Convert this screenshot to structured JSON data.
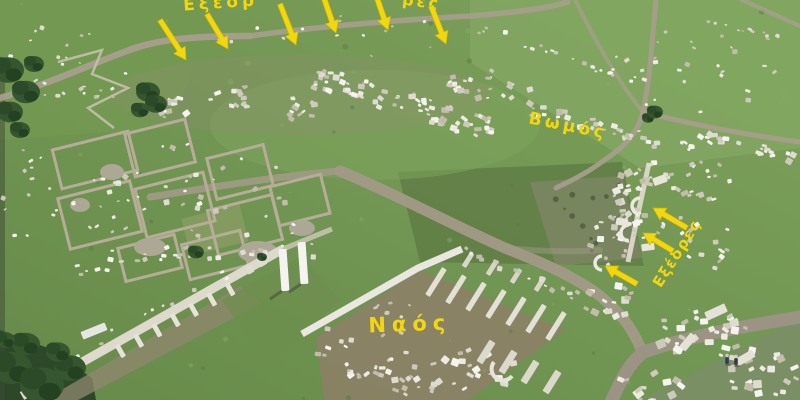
{
  "photo": {
    "kind": "annotated-aerial-photograph",
    "subject": "archaeological-site-ruins"
  },
  "annotations": {
    "text_color": "#f2d70e",
    "arrow_color": "#f2d70e",
    "labels": [
      {
        "id": "exedres-top-fragment",
        "text": "Εξέδρ",
        "x": 221,
        "y": 8,
        "rot": -4,
        "fs": 17,
        "ls": 4
      },
      {
        "id": "res-top-fragment",
        "text": "ρες",
        "x": 421,
        "y": 7,
        "rot": 7,
        "fs": 16,
        "ls": 3
      },
      {
        "id": "vomos",
        "text": "Βωμός",
        "x": 567,
        "y": 131,
        "rot": 11,
        "fs": 17,
        "ls": 3.5
      },
      {
        "id": "naos",
        "text": "Ναός",
        "x": 410,
        "y": 331,
        "rot": -2,
        "fs": 21,
        "ls": 6
      },
      {
        "id": "exedres-right",
        "text": "Εξέδρες",
        "x": 681,
        "y": 256,
        "rot": -58,
        "fs": 15,
        "ls": 1.5
      }
    ],
    "arrows": [
      {
        "id": "arrow-top-1",
        "tail": [
          160,
          20
        ],
        "head": [
          186,
          60
        ]
      },
      {
        "id": "arrow-top-2",
        "tail": [
          207,
          14
        ],
        "head": [
          228,
          49
        ]
      },
      {
        "id": "arrow-top-3",
        "tail": [
          280,
          4
        ],
        "head": [
          296,
          45
        ]
      },
      {
        "id": "arrow-top-4",
        "tail": [
          324,
          -2
        ],
        "head": [
          336,
          33
        ]
      },
      {
        "id": "arrow-top-5",
        "tail": [
          377,
          -2
        ],
        "head": [
          388,
          30
        ]
      },
      {
        "id": "arrow-top-6",
        "tail": [
          431,
          6
        ],
        "head": [
          446,
          44
        ]
      },
      {
        "id": "arrow-right-1",
        "tail": [
          687,
          228
        ],
        "head": [
          653,
          208
        ]
      },
      {
        "id": "arrow-right-2",
        "tail": [
          673,
          251
        ],
        "head": [
          643,
          233
        ]
      },
      {
        "id": "arrow-right-3",
        "tail": [
          637,
          284
        ],
        "head": [
          605,
          266
        ]
      }
    ]
  },
  "scene": {
    "people": [
      {
        "x": 727,
        "y": 357
      },
      {
        "x": 736,
        "y": 358
      }
    ],
    "feature_names": [
      "temple-ruins",
      "altar-ruins",
      "exedrae-ruins",
      "stoa-colonnade",
      "agora-foundations",
      "dirt-paths",
      "grass-field",
      "trees",
      "scattered-stones",
      "people"
    ]
  }
}
